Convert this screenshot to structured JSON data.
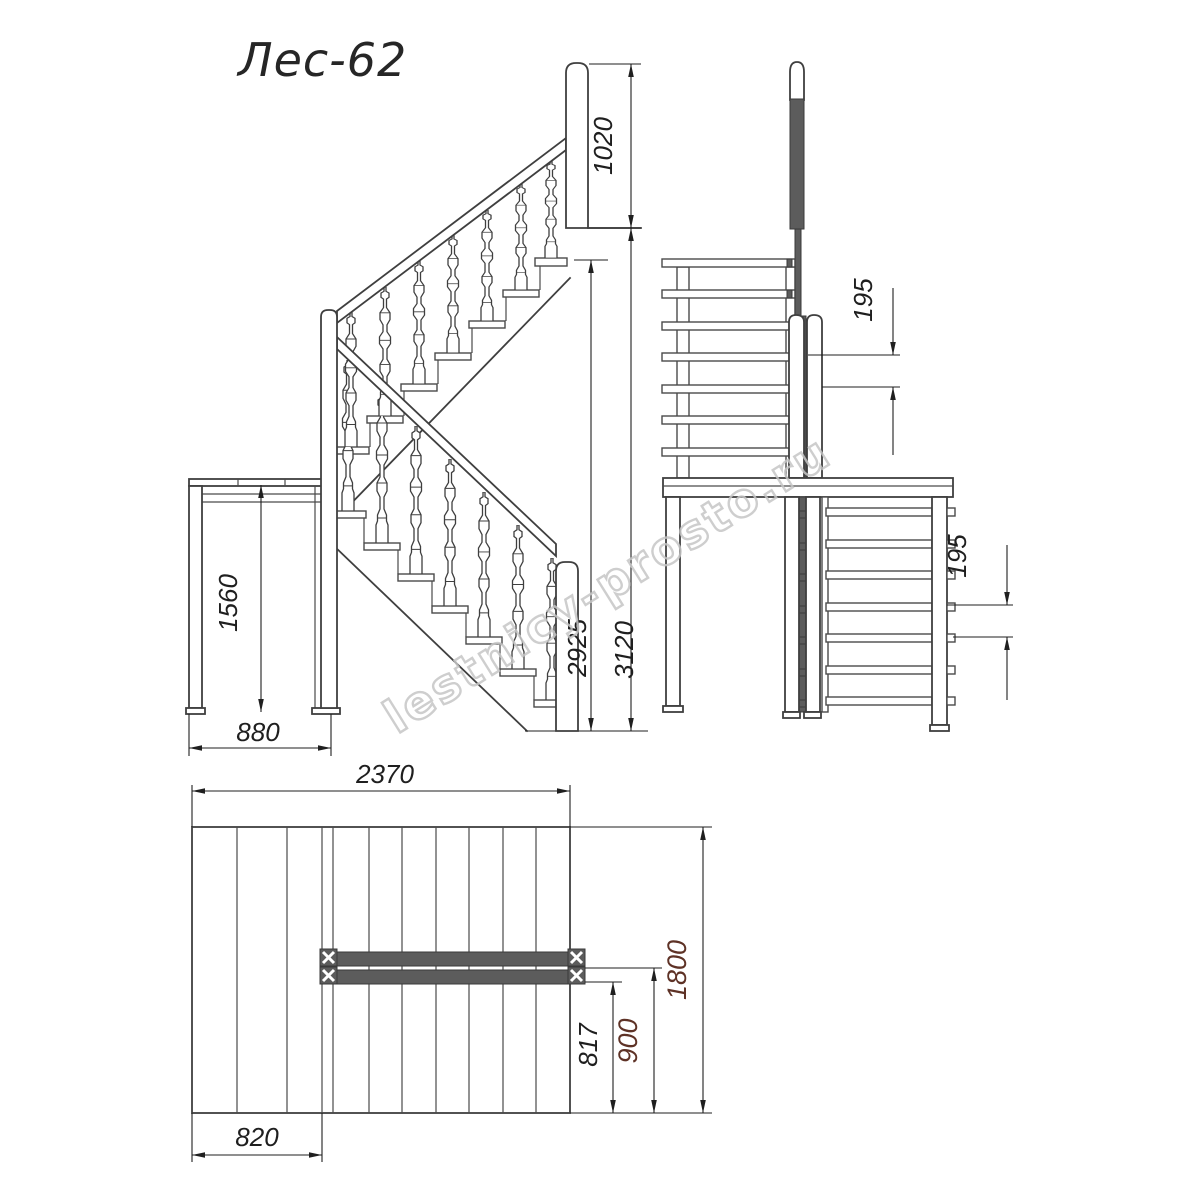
{
  "title": "Лес-62",
  "watermark": "lestnicy-prosto.ru",
  "units": "mm",
  "colors": {
    "line": "#3f3f3f",
    "dimension": "#1f1f1f",
    "accent_dimension": "#5e3226",
    "dark_fill": "#5c5c5c",
    "watermark": "#c6c6c6",
    "background": "#ffffff"
  },
  "side_view": {
    "label": "side-elevation",
    "dimensions": {
      "newel_above_floor": "1020",
      "total_height": "3120",
      "height_to_top_tread": "2925",
      "landing_height": "1560",
      "landing_depth": "880"
    }
  },
  "front_view": {
    "label": "front-elevation",
    "dimensions": {
      "riser_upper": "195",
      "riser_lower": "195"
    }
  },
  "plan_view": {
    "label": "plan",
    "dimensions": {
      "overall_length": "2370",
      "overall_width": "1800",
      "landing_width": "820",
      "rail_axis_offset": "900",
      "rail_edge_offset": "817"
    }
  }
}
